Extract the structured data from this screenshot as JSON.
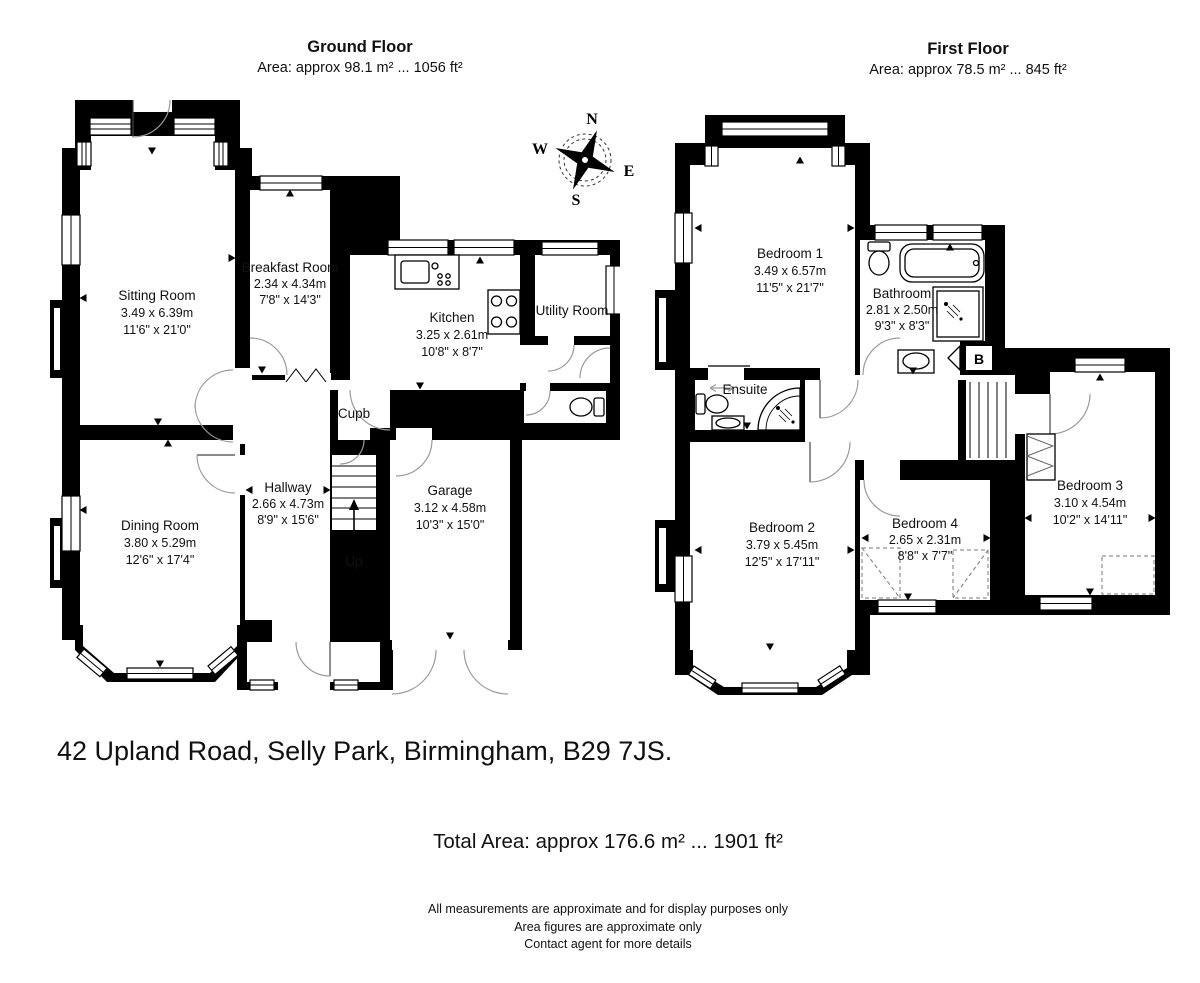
{
  "ground_floor": {
    "title": "Ground Floor",
    "area_line": "Area: approx 98.1 m² ... 1056 ft²",
    "stairs_label": "Up",
    "rooms": {
      "sitting_room": {
        "name": "Sitting Room",
        "metric": "3.49 x 6.39m",
        "imperial": "11'6\" x 21'0\""
      },
      "breakfast_room": {
        "name": "Breakfast Room",
        "metric": "2.34 x 4.34m",
        "imperial": "7'8\" x 14'3\""
      },
      "kitchen": {
        "name": "Kitchen",
        "metric": "3.25 x 2.61m",
        "imperial": "10'8\" x 8'7\""
      },
      "utility_room": {
        "name": "Utility Room"
      },
      "cupboard": {
        "name": "Cupb"
      },
      "hallway": {
        "name": "Hallway",
        "metric": "2.66 x 4.73m",
        "imperial": "8'9\" x 15'6\""
      },
      "garage": {
        "name": "Garage",
        "metric": "3.12 x 4.58m",
        "imperial": "10'3\" x 15'0\""
      },
      "dining_room": {
        "name": "Dining Room",
        "metric": "3.80 x 5.29m",
        "imperial": "12'6\" x 17'4\""
      }
    }
  },
  "first_floor": {
    "title": "First Floor",
    "area_line": "Area: approx 78.5 m² ... 845 ft²",
    "boiler_label": "B",
    "rooms": {
      "bedroom_1": {
        "name": "Bedroom 1",
        "metric": "3.49 x 6.57m",
        "imperial": "11'5\" x 21'7\""
      },
      "bathroom": {
        "name": "Bathroom",
        "metric": "2.81 x 2.50m",
        "imperial": "9'3\" x 8'3\""
      },
      "ensuite": {
        "name": "Ensuite"
      },
      "bedroom_2": {
        "name": "Bedroom 2",
        "metric": "3.79 x 5.45m",
        "imperial": "12'5\" x 17'11\""
      },
      "bedroom_4": {
        "name": "Bedroom 4",
        "metric": "2.65 x 2.31m",
        "imperial": "8'8\" x 7'7\""
      },
      "bedroom_3": {
        "name": "Bedroom 3",
        "metric": "3.10 x 4.54m",
        "imperial": "10'2\" x 14'11\""
      }
    }
  },
  "compass": {
    "n": "N",
    "e": "E",
    "s": "S",
    "w": "W"
  },
  "address": "42 Upland Road, Selly Park, Birmingham, B29 7JS.",
  "total_area": "Total Area: approx 176.6 m² ... 1901 ft²",
  "disclaimer": {
    "line1": "All measurements are approximate and for display purposes only",
    "line2": "Area figures are approximate only",
    "line3": "Contact agent for more details"
  },
  "colors": {
    "wall": "#000000",
    "paper": "#ffffff",
    "door_arc": "#9a9a9a"
  }
}
